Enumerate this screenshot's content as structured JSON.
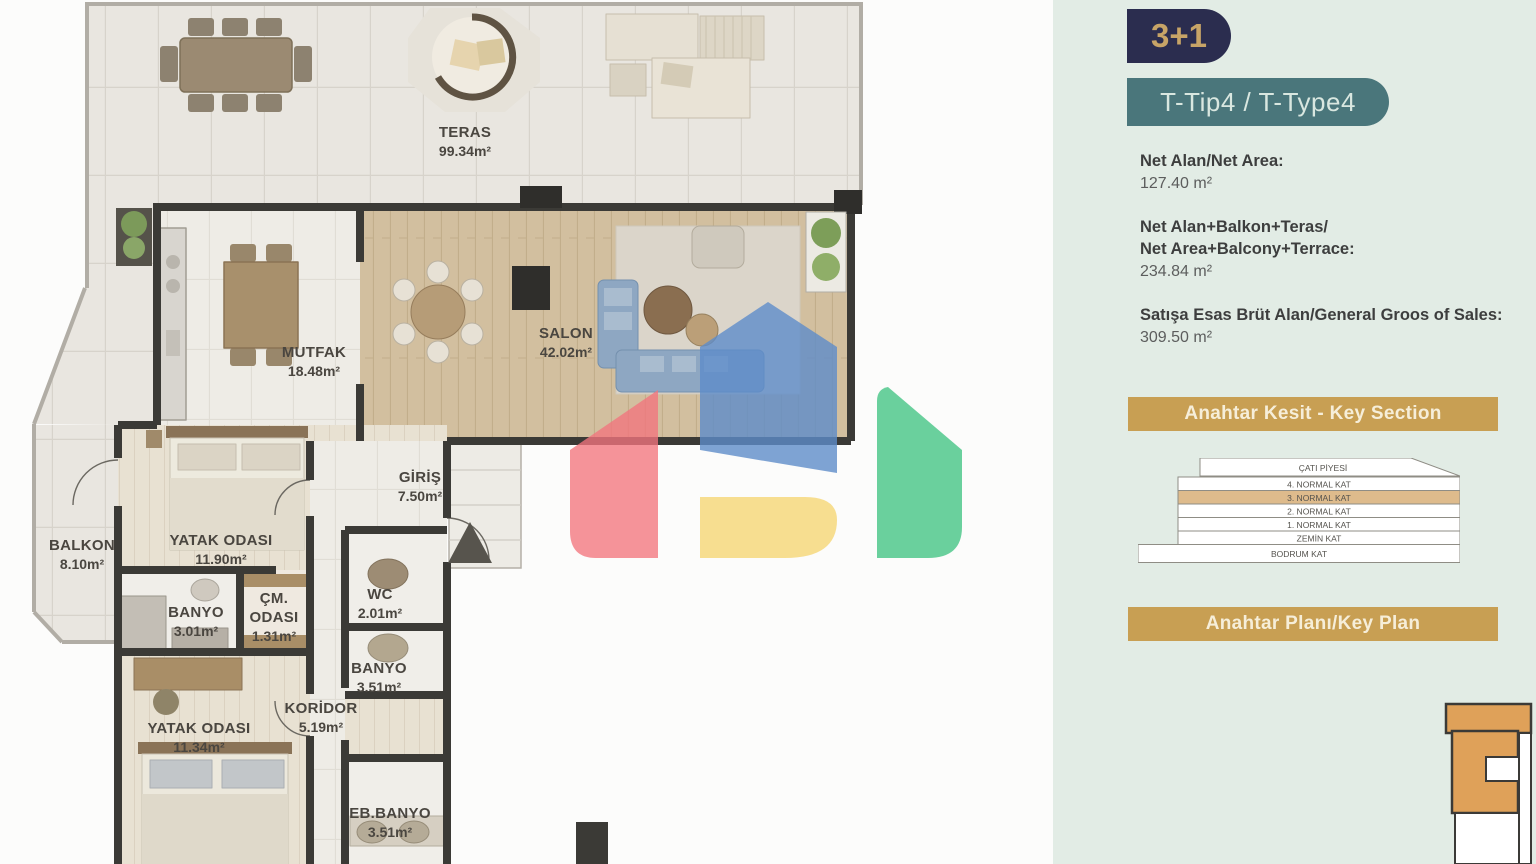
{
  "plan": {
    "rooms": [
      {
        "name": "TERAS",
        "area": "99.34m²",
        "x": 465,
        "y": 105
      },
      {
        "name": "MUTFAK",
        "area": "18.48m²",
        "x": 314,
        "y": 325
      },
      {
        "name": "SALON",
        "area": "42.02m²",
        "x": 566,
        "y": 306
      },
      {
        "name": "GİRİŞ",
        "area": "7.50m²",
        "x": 420,
        "y": 450
      },
      {
        "name": "YATAK ODASI",
        "area": "11.90m²",
        "x": 221,
        "y": 513
      },
      {
        "name": "BALKON",
        "area": "8.10m²",
        "x": 82,
        "y": 518
      },
      {
        "name": "BANYO",
        "area": "3.01m²",
        "x": 196,
        "y": 585
      },
      {
        "name": "ÇM.\nODASI",
        "area": "1.31m²",
        "x": 274,
        "y": 571
      },
      {
        "name": "WC",
        "area": "2.01m²",
        "x": 380,
        "y": 567
      },
      {
        "name": "BANYO",
        "area": "3.51m²",
        "x": 379,
        "y": 641
      },
      {
        "name": "KORİDOR",
        "area": "5.19m²",
        "x": 321,
        "y": 681
      },
      {
        "name": "YATAK ODASI",
        "area": "11.34m²",
        "x": 199,
        "y": 701
      },
      {
        "name": "EB.BANYO",
        "area": "3.51m²",
        "x": 390,
        "y": 786
      },
      {
        "name": "EB.YATAK ODASI",
        "area": "",
        "x": 322,
        "y": 852
      }
    ],
    "north_marker": "entrance-arrow"
  },
  "sidebar": {
    "unit_badge": "3+1",
    "type_badge": "T-Tip4 / T-Type4",
    "stats": [
      {
        "label": "Net Alan/Net Area:",
        "value": "127.40 m²"
      },
      {
        "label": "Net Alan+Balkon+Teras/\nNet Area+Balcony+Terrace:",
        "value": "234.84 m²"
      },
      {
        "label": "Satışa Esas Brüt Alan/General Groos of Sales:",
        "value": "309.50 m²"
      }
    ],
    "key_section": {
      "title": "Anahtar Kesit - Key Section",
      "floors": [
        "ÇATI PİYESİ",
        "4. NORMAL KAT",
        "3. NORMAL KAT",
        "2. NORMAL KAT",
        "1. NORMAL KAT",
        "ZEMİN KAT",
        "BODRUM KAT"
      ],
      "highlighted_floor": "3. NORMAL KAT"
    },
    "key_plan": {
      "title": "Anahtar Planı/Key Plan"
    }
  },
  "colors": {
    "sidebar_bg": "#e2ece5",
    "unit_badge_bg": "#2b2d4f",
    "unit_badge_text": "#c7a467",
    "type_badge_bg": "#4a767b",
    "banner_bg": "#c89f53",
    "highlight_floor": "#debb8c",
    "key_plan_unit": "#dfa159",
    "watermark_red": "#f2757d",
    "watermark_blue": "#5e8cc9",
    "watermark_yellow": "#f6d87c",
    "watermark_green": "#50c88c"
  }
}
